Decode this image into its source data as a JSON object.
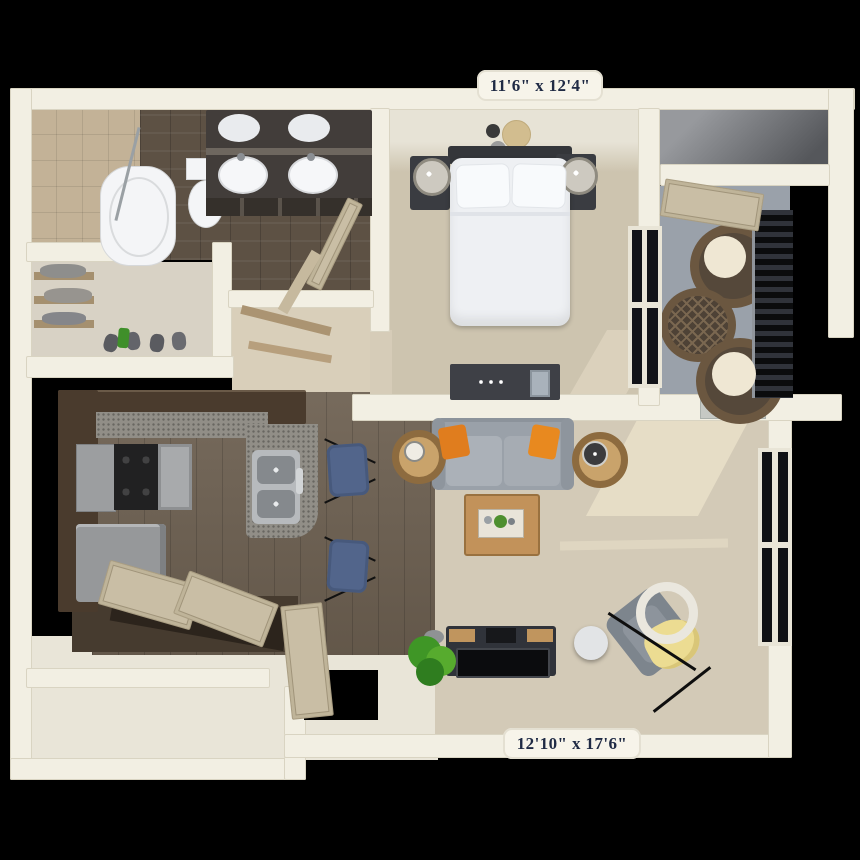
{
  "scene": {
    "description": "3D top-down apartment floor plan render on black background",
    "background": "#000000"
  },
  "labels": {
    "bedroom_dimensions": "11'6\" x 12'4\"",
    "living_room_dimensions": "12'10\" x 17'6\""
  },
  "colors": {
    "background": "#000000",
    "wall": "#f2efe3",
    "bedroom_carpet": "#cdc4af",
    "living_carpet": "#d3cab7",
    "bathroom_wood": "#5d5144",
    "kitchen_wood": "#6e6152",
    "shower_tile": "#c3b297",
    "balcony_floor": "#9aa1aa",
    "cabinet_brown": "#4a3b2d",
    "counter_speckle": "#918e87",
    "stainless": "#9c9ea0",
    "sofa_gray": "#9aa1a9",
    "pillow_orange": "#e07d1e",
    "stool_blue": "#52658b",
    "throw_gold": "#ecdc92",
    "table_wood": "#c2925a",
    "door_beige": "#c9bea5",
    "label_background": "#f7f4ea",
    "label_text": "#1f2a44"
  },
  "rooms": [
    {
      "name": "bathroom",
      "items": [
        "bathtub",
        "shower",
        "toilet",
        "double-vanity-sinks",
        "open-door"
      ]
    },
    {
      "name": "walk-in-closet",
      "items": [
        "shelves",
        "clothes",
        "shoes"
      ]
    },
    {
      "name": "bedroom",
      "items": [
        "bed",
        "pillows",
        "headboard",
        "nightstands",
        "table-lamps",
        "dresser",
        "wall-plates",
        "window"
      ]
    },
    {
      "name": "storage-closet",
      "items": []
    },
    {
      "name": "balcony",
      "items": [
        "wicker-chairs",
        "wicker-table",
        "railing",
        "open-door"
      ]
    },
    {
      "name": "kitchen",
      "items": [
        "cabinets",
        "range-cooktop",
        "microwave",
        "refrigerator",
        "island",
        "double-sink",
        "bar-stools",
        "bifold-doors"
      ]
    },
    {
      "name": "living-room",
      "items": [
        "sofa",
        "orange-pillows",
        "side-tables",
        "coffee-table",
        "tray",
        "tv-console",
        "tv",
        "accent-chair",
        "gold-throw",
        "arc-floor-lamp",
        "plant",
        "window"
      ]
    },
    {
      "name": "entry",
      "items": [
        "front-door",
        "door-opening"
      ]
    }
  ]
}
